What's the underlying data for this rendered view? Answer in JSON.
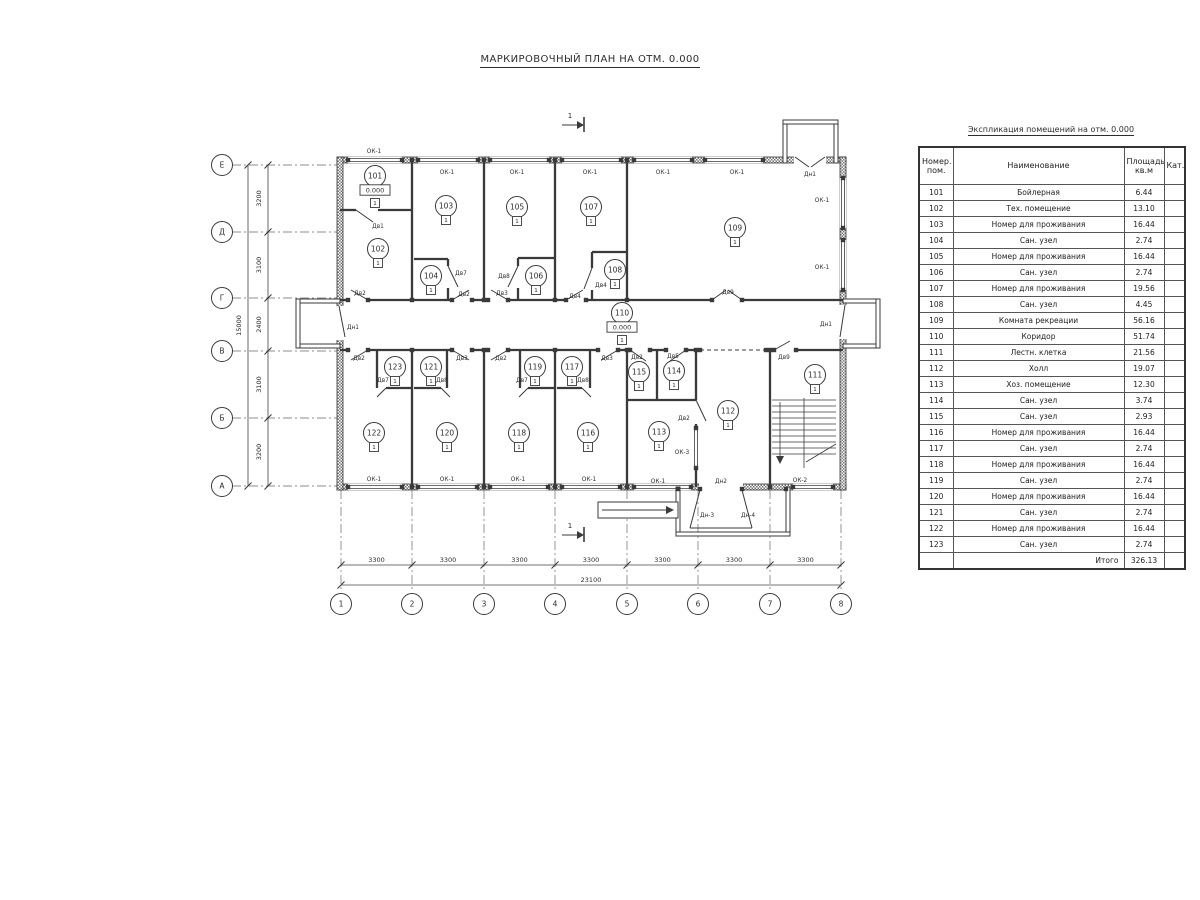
{
  "title": "МАРКИРОВОЧНЫЙ ПЛАН НА ОТМ. 0.000",
  "table": {
    "title": "Экспликация помещений на отм. 0.000",
    "headers": {
      "num": "Номер.\nпом.",
      "name": "Наименование",
      "area": "Площадь\nкв.м",
      "cat": "Кат."
    },
    "rows": [
      {
        "num": "101",
        "name": "Бойлерная",
        "area": "6.44",
        "cat": ""
      },
      {
        "num": "102",
        "name": "Тех. помещение",
        "area": "13.10",
        "cat": ""
      },
      {
        "num": "103",
        "name": "Номер для проживания",
        "area": "16.44",
        "cat": ""
      },
      {
        "num": "104",
        "name": "Сан. узел",
        "area": "2.74",
        "cat": ""
      },
      {
        "num": "105",
        "name": "Номер для проживания",
        "area": "16.44",
        "cat": ""
      },
      {
        "num": "106",
        "name": "Сан. узел",
        "area": "2.74",
        "cat": ""
      },
      {
        "num": "107",
        "name": "Номер для проживания",
        "area": "19.56",
        "cat": ""
      },
      {
        "num": "108",
        "name": "Сан. узел",
        "area": "4.45",
        "cat": ""
      },
      {
        "num": "109",
        "name": "Комната рекреации",
        "area": "56.16",
        "cat": ""
      },
      {
        "num": "110",
        "name": "Коридор",
        "area": "51.74",
        "cat": ""
      },
      {
        "num": "111",
        "name": "Лестн. клетка",
        "area": "21.56",
        "cat": ""
      },
      {
        "num": "112",
        "name": "Холл",
        "area": "19.07",
        "cat": ""
      },
      {
        "num": "113",
        "name": "Хоз. помещение",
        "area": "12.30",
        "cat": ""
      },
      {
        "num": "114",
        "name": "Сан. узел",
        "area": "3.74",
        "cat": ""
      },
      {
        "num": "115",
        "name": "Сан. узел",
        "area": "2.93",
        "cat": ""
      },
      {
        "num": "116",
        "name": "Номер для проживания",
        "area": "16.44",
        "cat": ""
      },
      {
        "num": "117",
        "name": "Сан. узел",
        "area": "2.74",
        "cat": ""
      },
      {
        "num": "118",
        "name": "Номер для проживания",
        "area": "16.44",
        "cat": ""
      },
      {
        "num": "119",
        "name": "Сан. узел",
        "area": "2.74",
        "cat": ""
      },
      {
        "num": "120",
        "name": "Номер для проживания",
        "area": "16.44",
        "cat": ""
      },
      {
        "num": "121",
        "name": "Сан. узел",
        "area": "2.74",
        "cat": ""
      },
      {
        "num": "122",
        "name": "Номер для проживания",
        "area": "16.44",
        "cat": ""
      },
      {
        "num": "123",
        "name": "Сан. узел",
        "area": "2.74",
        "cat": ""
      }
    ],
    "total_label": "Итого",
    "total_value": "326.13"
  },
  "plan": {
    "floor_mark": "1",
    "level_text": "0.000",
    "ext_walls": [
      [
        337,
        157,
        509,
        6
      ],
      [
        337,
        484,
        509,
        6
      ],
      [
        337,
        157,
        6,
        333
      ],
      [
        840,
        157,
        6,
        333
      ]
    ],
    "thin_rects": [
      [
        296,
        299,
        44,
        4
      ],
      [
        296,
        344,
        44,
        4
      ],
      [
        296,
        299,
        4,
        49
      ],
      [
        843,
        299,
        37,
        4
      ],
      [
        843,
        344,
        37,
        4
      ],
      [
        876,
        299,
        4,
        49
      ],
      [
        783,
        120,
        4,
        43
      ],
      [
        834,
        120,
        4,
        43
      ],
      [
        783,
        120,
        55,
        4
      ],
      [
        676,
        487,
        4,
        49
      ],
      [
        786,
        487,
        4,
        49
      ],
      [
        676,
        532,
        114,
        4
      ],
      [
        598,
        502,
        80,
        16
      ]
    ],
    "door_gaps": [
      [
        336,
        306,
        8,
        34
      ],
      [
        839,
        305,
        8,
        34
      ],
      [
        794,
        156,
        32,
        8
      ],
      [
        699,
        483,
        44,
        8
      ]
    ],
    "win_h": [
      [
        348,
        402,
        160
      ],
      [
        418,
        478,
        160
      ],
      [
        490,
        549,
        160
      ],
      [
        562,
        621,
        160
      ],
      [
        634,
        692,
        160
      ],
      [
        705,
        763,
        160
      ],
      [
        348,
        402,
        487
      ],
      [
        418,
        477,
        487
      ],
      [
        490,
        548,
        487
      ],
      [
        562,
        620,
        487
      ],
      [
        634,
        691,
        487
      ],
      [
        793,
        833,
        487
      ]
    ],
    "win_v": [
      [
        178,
        228,
        843
      ],
      [
        240,
        290,
        843
      ],
      [
        428,
        468,
        696
      ]
    ],
    "int_walls": [
      [
        412,
        160,
        412,
        300
      ],
      [
        484,
        160,
        484,
        300
      ],
      [
        555,
        160,
        555,
        300
      ],
      [
        627,
        160,
        627,
        300
      ],
      [
        340,
        300,
        348,
        300
      ],
      [
        368,
        300,
        452,
        300
      ],
      [
        472,
        300,
        488,
        300
      ],
      [
        508,
        300,
        566,
        300
      ],
      [
        586,
        300,
        712,
        300
      ],
      [
        742,
        300,
        843,
        300
      ],
      [
        340,
        350,
        348,
        350
      ],
      [
        368,
        350,
        452,
        350
      ],
      [
        472,
        350,
        488,
        350
      ],
      [
        508,
        350,
        598,
        350
      ],
      [
        618,
        350,
        630,
        350
      ],
      [
        650,
        350,
        666,
        350
      ],
      [
        686,
        350,
        700,
        350
      ],
      [
        766,
        350,
        774,
        350
      ],
      [
        796,
        350,
        843,
        350
      ],
      [
        340,
        210,
        356,
        210
      ],
      [
        378,
        210,
        412,
        210
      ],
      [
        414,
        259,
        448,
        259
      ],
      [
        448,
        259,
        448,
        266
      ],
      [
        448,
        288,
        448,
        300
      ],
      [
        518,
        258,
        555,
        258
      ],
      [
        518,
        258,
        518,
        266
      ],
      [
        518,
        288,
        518,
        300
      ],
      [
        592,
        252,
        627,
        252
      ],
      [
        592,
        252,
        592,
        268
      ],
      [
        592,
        290,
        592,
        300
      ],
      [
        412,
        350,
        412,
        487
      ],
      [
        484,
        350,
        484,
        487
      ],
      [
        555,
        350,
        555,
        487
      ],
      [
        627,
        350,
        627,
        487
      ],
      [
        770,
        350,
        770,
        487
      ],
      [
        696,
        350,
        696,
        400
      ],
      [
        696,
        424,
        696,
        428
      ],
      [
        696,
        468,
        696,
        487
      ],
      [
        377,
        350,
        377,
        388
      ],
      [
        386,
        388,
        412,
        388
      ],
      [
        447,
        350,
        447,
        388
      ],
      [
        414,
        388,
        441,
        388
      ],
      [
        520,
        350,
        520,
        388
      ],
      [
        528,
        388,
        555,
        388
      ],
      [
        590,
        350,
        590,
        388
      ],
      [
        557,
        388,
        582,
        388
      ],
      [
        657,
        350,
        657,
        400
      ],
      [
        627,
        400,
        696,
        400
      ]
    ],
    "dashed": [
      [
        700,
        350,
        766,
        350
      ]
    ],
    "leaves": [
      [
        356,
        210,
        373,
        222
      ],
      [
        448,
        266,
        458,
        287
      ],
      [
        518,
        266,
        508,
        287
      ],
      [
        592,
        268,
        584,
        289
      ],
      [
        368,
        300,
        351,
        290
      ],
      [
        452,
        300,
        469,
        290
      ],
      [
        508,
        300,
        491,
        290
      ],
      [
        566,
        300,
        583,
        290
      ],
      [
        712,
        300,
        726,
        290
      ],
      [
        742,
        300,
        728,
        290
      ],
      [
        368,
        350,
        351,
        360
      ],
      [
        452,
        350,
        469,
        360
      ],
      [
        508,
        350,
        491,
        360
      ],
      [
        618,
        350,
        601,
        360
      ],
      [
        630,
        350,
        646,
        361
      ],
      [
        686,
        350,
        670,
        361
      ],
      [
        774,
        350,
        790,
        341
      ],
      [
        696,
        400,
        706,
        421
      ],
      [
        386,
        388,
        377,
        397
      ],
      [
        441,
        388,
        450,
        397
      ],
      [
        528,
        388,
        519,
        397
      ],
      [
        582,
        388,
        591,
        397
      ],
      [
        339,
        306,
        345,
        337
      ],
      [
        845,
        305,
        840,
        337
      ],
      [
        795,
        157,
        809,
        167
      ],
      [
        825,
        157,
        811,
        167
      ],
      [
        700,
        490,
        690,
        528
      ],
      [
        742,
        490,
        752,
        528
      ],
      [
        690,
        528,
        752,
        528
      ],
      [
        602,
        510,
        666,
        510
      ]
    ],
    "jamb_rows": [
      {
        "y": 160,
        "xs": [
          348,
          402,
          412,
          418,
          478,
          484,
          490,
          549,
          555,
          562,
          621,
          627,
          634,
          692,
          705,
          763
        ]
      },
      {
        "y": 300,
        "xs": [
          348,
          368,
          412,
          452,
          472,
          484,
          488,
          508,
          555,
          566,
          586,
          627,
          712,
          742
        ]
      },
      {
        "y": 350,
        "xs": [
          348,
          368,
          412,
          452,
          472,
          484,
          488,
          508,
          555,
          598,
          618,
          627,
          630,
          650,
          666,
          686,
          696,
          700,
          766,
          770,
          774,
          796
        ]
      },
      {
        "y": 487,
        "xs": [
          348,
          402,
          412,
          418,
          477,
          484,
          490,
          548,
          555,
          562,
          620,
          627,
          634,
          691,
          770,
          793,
          833
        ]
      },
      {
        "y": 489,
        "xs": [
          678,
          700,
          742,
          786
        ]
      }
    ],
    "jamb_cols": [
      {
        "x": 843,
        "ys": [
          178,
          228,
          240,
          290
        ]
      },
      {
        "x": 696,
        "ys": [
          428,
          468
        ]
      }
    ],
    "stairs": {
      "x1": 772,
      "x2": 836,
      "yTop": 400,
      "yBot": 456,
      "step": 6,
      "div": [
        804,
        398,
        804,
        468
      ],
      "arrow": [
        780,
        402,
        780,
        456
      ],
      "diag": [
        806,
        462,
        836,
        444
      ]
    },
    "polys": [
      [
        666,
        506,
        674,
        510,
        666,
        514
      ],
      [
        776,
        456,
        784,
        456,
        780,
        464
      ],
      [
        577,
        121,
        584,
        125,
        577,
        129
      ],
      [
        577,
        531,
        584,
        535,
        577,
        539
      ]
    ],
    "sections": [
      {
        "label": "1",
        "tx": 570,
        "ty": 118,
        "line": [
          562,
          125,
          577,
          125
        ],
        "tick": [
          584,
          117,
          584,
          132
        ]
      },
      {
        "label": "1",
        "tx": 570,
        "ty": 528,
        "line": [
          562,
          535,
          577,
          535
        ],
        "tick": [
          584,
          527,
          584,
          542
        ]
      }
    ],
    "rooms": [
      {
        "n": "101",
        "x": 375,
        "y": 176,
        "lvl": true
      },
      {
        "n": "102",
        "x": 378,
        "y": 249
      },
      {
        "n": "103",
        "x": 446,
        "y": 206
      },
      {
        "n": "104",
        "x": 431,
        "y": 276
      },
      {
        "n": "105",
        "x": 517,
        "y": 207
      },
      {
        "n": "106",
        "x": 536,
        "y": 276
      },
      {
        "n": "107",
        "x": 591,
        "y": 207
      },
      {
        "n": "108",
        "x": 615,
        "y": 270
      },
      {
        "n": "109",
        "x": 735,
        "y": 228
      },
      {
        "n": "110",
        "x": 622,
        "y": 313,
        "lvl": true
      },
      {
        "n": "111",
        "x": 815,
        "y": 375
      },
      {
        "n": "112",
        "x": 728,
        "y": 411
      },
      {
        "n": "113",
        "x": 659,
        "y": 432
      },
      {
        "n": "114",
        "x": 674,
        "y": 371
      },
      {
        "n": "115",
        "x": 639,
        "y": 372
      },
      {
        "n": "116",
        "x": 588,
        "y": 433
      },
      {
        "n": "117",
        "x": 572,
        "y": 367
      },
      {
        "n": "118",
        "x": 519,
        "y": 433
      },
      {
        "n": "119",
        "x": 535,
        "y": 367
      },
      {
        "n": "120",
        "x": 447,
        "y": 433
      },
      {
        "n": "121",
        "x": 431,
        "y": 367
      },
      {
        "n": "122",
        "x": 374,
        "y": 433
      },
      {
        "n": "123",
        "x": 395,
        "y": 367
      }
    ],
    "labels": [
      [
        "ОК-1",
        374,
        151
      ],
      [
        "ОК-1",
        447,
        172
      ],
      [
        "ОК-1",
        517,
        172
      ],
      [
        "ОК-1",
        590,
        172
      ],
      [
        "ОК-1",
        663,
        172
      ],
      [
        "ОК-1",
        737,
        172
      ],
      [
        "ОК-1",
        822,
        200
      ],
      [
        "ОК-1",
        822,
        267
      ],
      [
        "ОК-1",
        374,
        479
      ],
      [
        "ОК-1",
        447,
        479
      ],
      [
        "ОК-1",
        518,
        479
      ],
      [
        "ОК-1",
        589,
        479
      ],
      [
        "ОК-1",
        658,
        481
      ],
      [
        "ОК-2",
        800,
        480
      ],
      [
        "ОК-3",
        682,
        452
      ],
      [
        "Дв1",
        378,
        226
      ],
      [
        "Дв2",
        360,
        293
      ],
      [
        "Дв2",
        464,
        294
      ],
      [
        "Дв3",
        502,
        293
      ],
      [
        "Дв4",
        575,
        296
      ],
      [
        "Дв9",
        728,
        292
      ],
      [
        "Дв7",
        461,
        273
      ],
      [
        "Дв8",
        504,
        276
      ],
      [
        "Дв4",
        601,
        285
      ],
      [
        "Дн1",
        353,
        327
      ],
      [
        "Дн1",
        826,
        324
      ],
      [
        "Дн1",
        810,
        174
      ],
      [
        "Дв2",
        359,
        358
      ],
      [
        "Дв3",
        462,
        358
      ],
      [
        "Дв2",
        501,
        358
      ],
      [
        "Дв3",
        607,
        358
      ],
      [
        "Дв2",
        637,
        357
      ],
      [
        "Дв5",
        673,
        356
      ],
      [
        "Дв9",
        784,
        357
      ],
      [
        "Дв7",
        383,
        380
      ],
      [
        "Дв8",
        442,
        380
      ],
      [
        "Дв7",
        522,
        380
      ],
      [
        "Дв8",
        583,
        380
      ],
      [
        "Дв2",
        684,
        418
      ],
      [
        "Дн2",
        721,
        481
      ],
      [
        "Дн-3",
        707,
        515
      ],
      [
        "Дн-4",
        748,
        515
      ]
    ],
    "axes_h": {
      "cy": 604,
      "r": 10.5,
      "items": [
        {
          "label": "1",
          "x": 341
        },
        {
          "label": "2",
          "x": 412
        },
        {
          "label": "3",
          "x": 484
        },
        {
          "label": "4",
          "x": 555
        },
        {
          "label": "5",
          "x": 627
        },
        {
          "label": "6",
          "x": 698
        },
        {
          "label": "7",
          "x": 770
        },
        {
          "label": "8",
          "x": 841
        }
      ],
      "dim_y": 565,
      "seg_label": "3300",
      "total_y": 585,
      "total": "23100"
    },
    "axes_v": {
      "cx": 222,
      "r": 10.5,
      "items": [
        {
          "label": "Е",
          "y": 165
        },
        {
          "label": "Д",
          "y": 232
        },
        {
          "label": "Г",
          "y": 298
        },
        {
          "label": "В",
          "y": 351
        },
        {
          "label": "Б",
          "y": 418
        },
        {
          "label": "А",
          "y": 486
        }
      ],
      "dim_x": 268,
      "seg_labels": [
        "3200",
        "3100",
        "2400",
        "3100",
        "3200"
      ],
      "total_x": 248,
      "total": "15000"
    }
  }
}
